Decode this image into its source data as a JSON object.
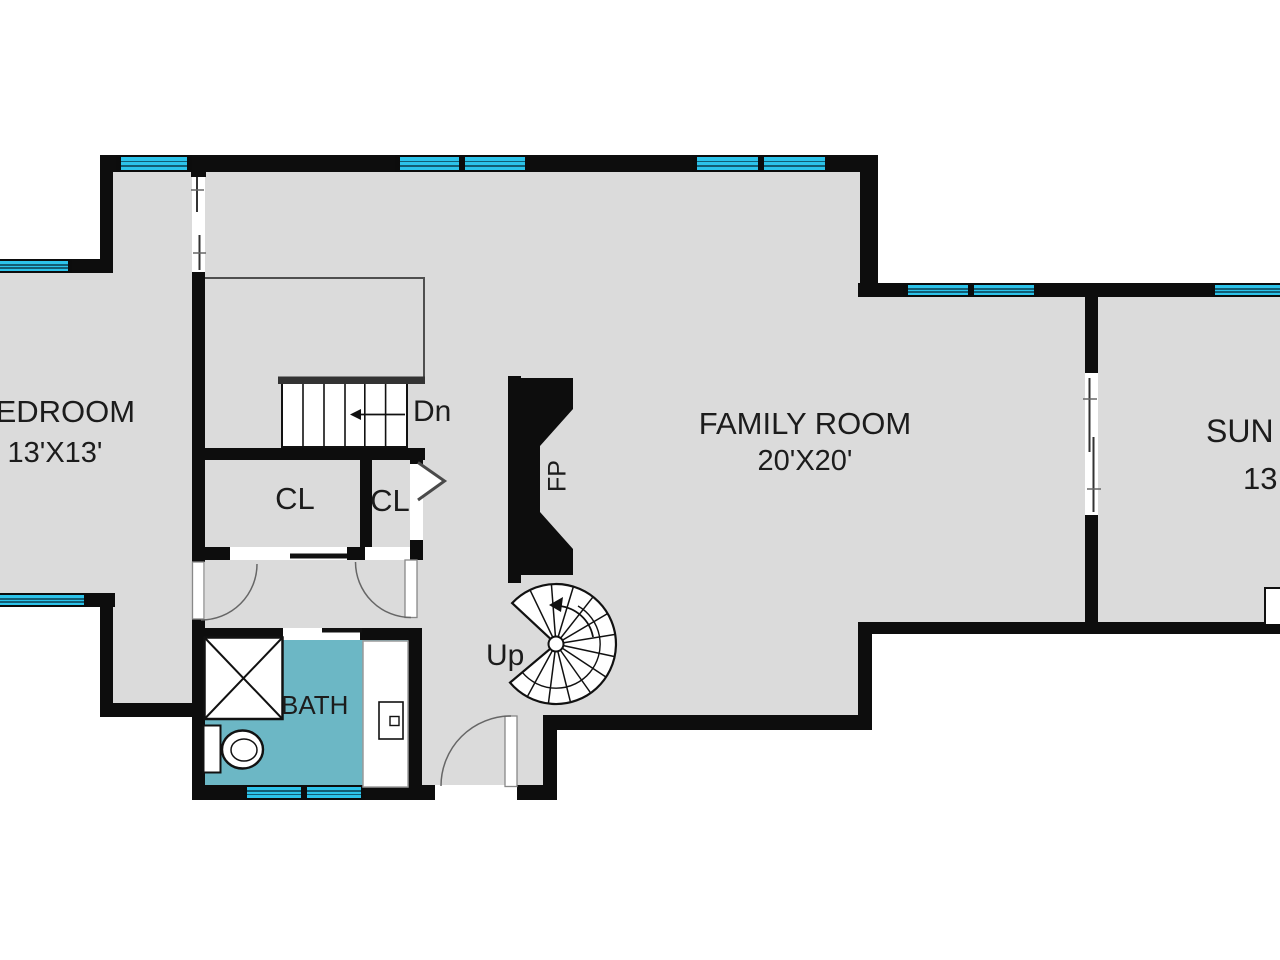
{
  "plan": {
    "title": "Lower level floor plan",
    "rooms": {
      "bedroom": {
        "label": "BEDROOM",
        "size": "13'X13'"
      },
      "family_room": {
        "label": "FAMILY ROOM",
        "size": "20'X20'"
      },
      "sun_room": {
        "label": "SUN",
        "size": "13"
      },
      "bath": {
        "label": "BATH"
      },
      "closet_1": {
        "label": "CL"
      },
      "closet_2": {
        "label": "CL"
      }
    },
    "stairs": {
      "down": "Dn",
      "up": "Up"
    },
    "fireplace": {
      "label": "FP"
    },
    "colors": {
      "floor": "#dbdbdb",
      "wall": "#0d0d0d",
      "window_glass": "#2cc3ea",
      "bath_floor": "#6cb7c5",
      "stairwell_outline": "#4f4f4f"
    }
  }
}
